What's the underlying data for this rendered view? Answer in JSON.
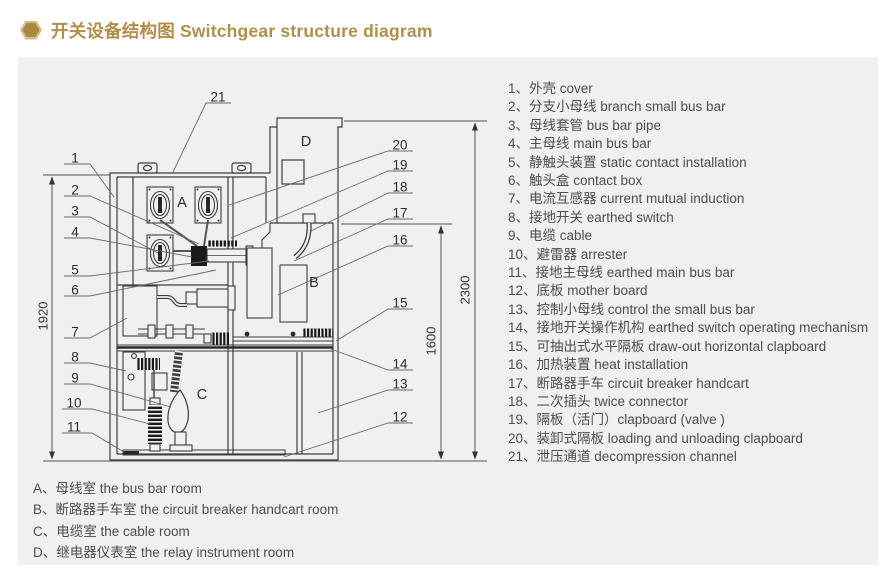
{
  "header": {
    "title": "开关设备结构图 Switchgear structure diagram"
  },
  "legend": {
    "items": [
      "1、外壳 cover",
      "2、分支小母线 branch small bus bar",
      "3、母线套管 bus bar pipe",
      "4、主母线 main bus bar",
      "5、静触头装置 static contact installation",
      "6、触头盒 contact box",
      "7、电流互感器 current mutual induction",
      "8、接地开关 earthed switch",
      "9、电缆 cable",
      "10、避雷器 arrester",
      "11、接地主母线 earthed main bus bar",
      "12、底板 mother board",
      "13、控制小母线 control the small bus bar",
      "14、接地开关操作机构 earthed switch operating mechanism",
      "15、可抽出式水平隔板 draw-out horizontal clapboard",
      "16、加热装置 heat installation",
      "17、断路器手车 circuit breaker handcart",
      "18、二次插头 twice connector",
      "19、隔板（活门）clapboard (valve )",
      "20、装卸式隔板 loading and unloading clapboard",
      "21、泄压通道 decompression channel"
    ]
  },
  "rooms": {
    "items": [
      "A、母线室 the bus bar room",
      "B、断路器手车室 the circuit breaker handcart room",
      "C、电缆室 the cable room",
      "D、继电器仪表室 the relay instrument room"
    ]
  },
  "diagram": {
    "callouts": [
      "1",
      "2",
      "3",
      "4",
      "5",
      "6",
      "7",
      "8",
      "9",
      "10",
      "11",
      "12",
      "13",
      "14",
      "15",
      "16",
      "17",
      "18",
      "19",
      "20",
      "21"
    ],
    "letters": [
      "A",
      "B",
      "C",
      "D"
    ],
    "dimensions": [
      "1920",
      "1600",
      "2300"
    ],
    "colors": {
      "accent_gold": "#b28e49",
      "panel_bg": "#f0f0f0",
      "line": "#3c3c3c",
      "text": "#4d4d4d"
    }
  }
}
